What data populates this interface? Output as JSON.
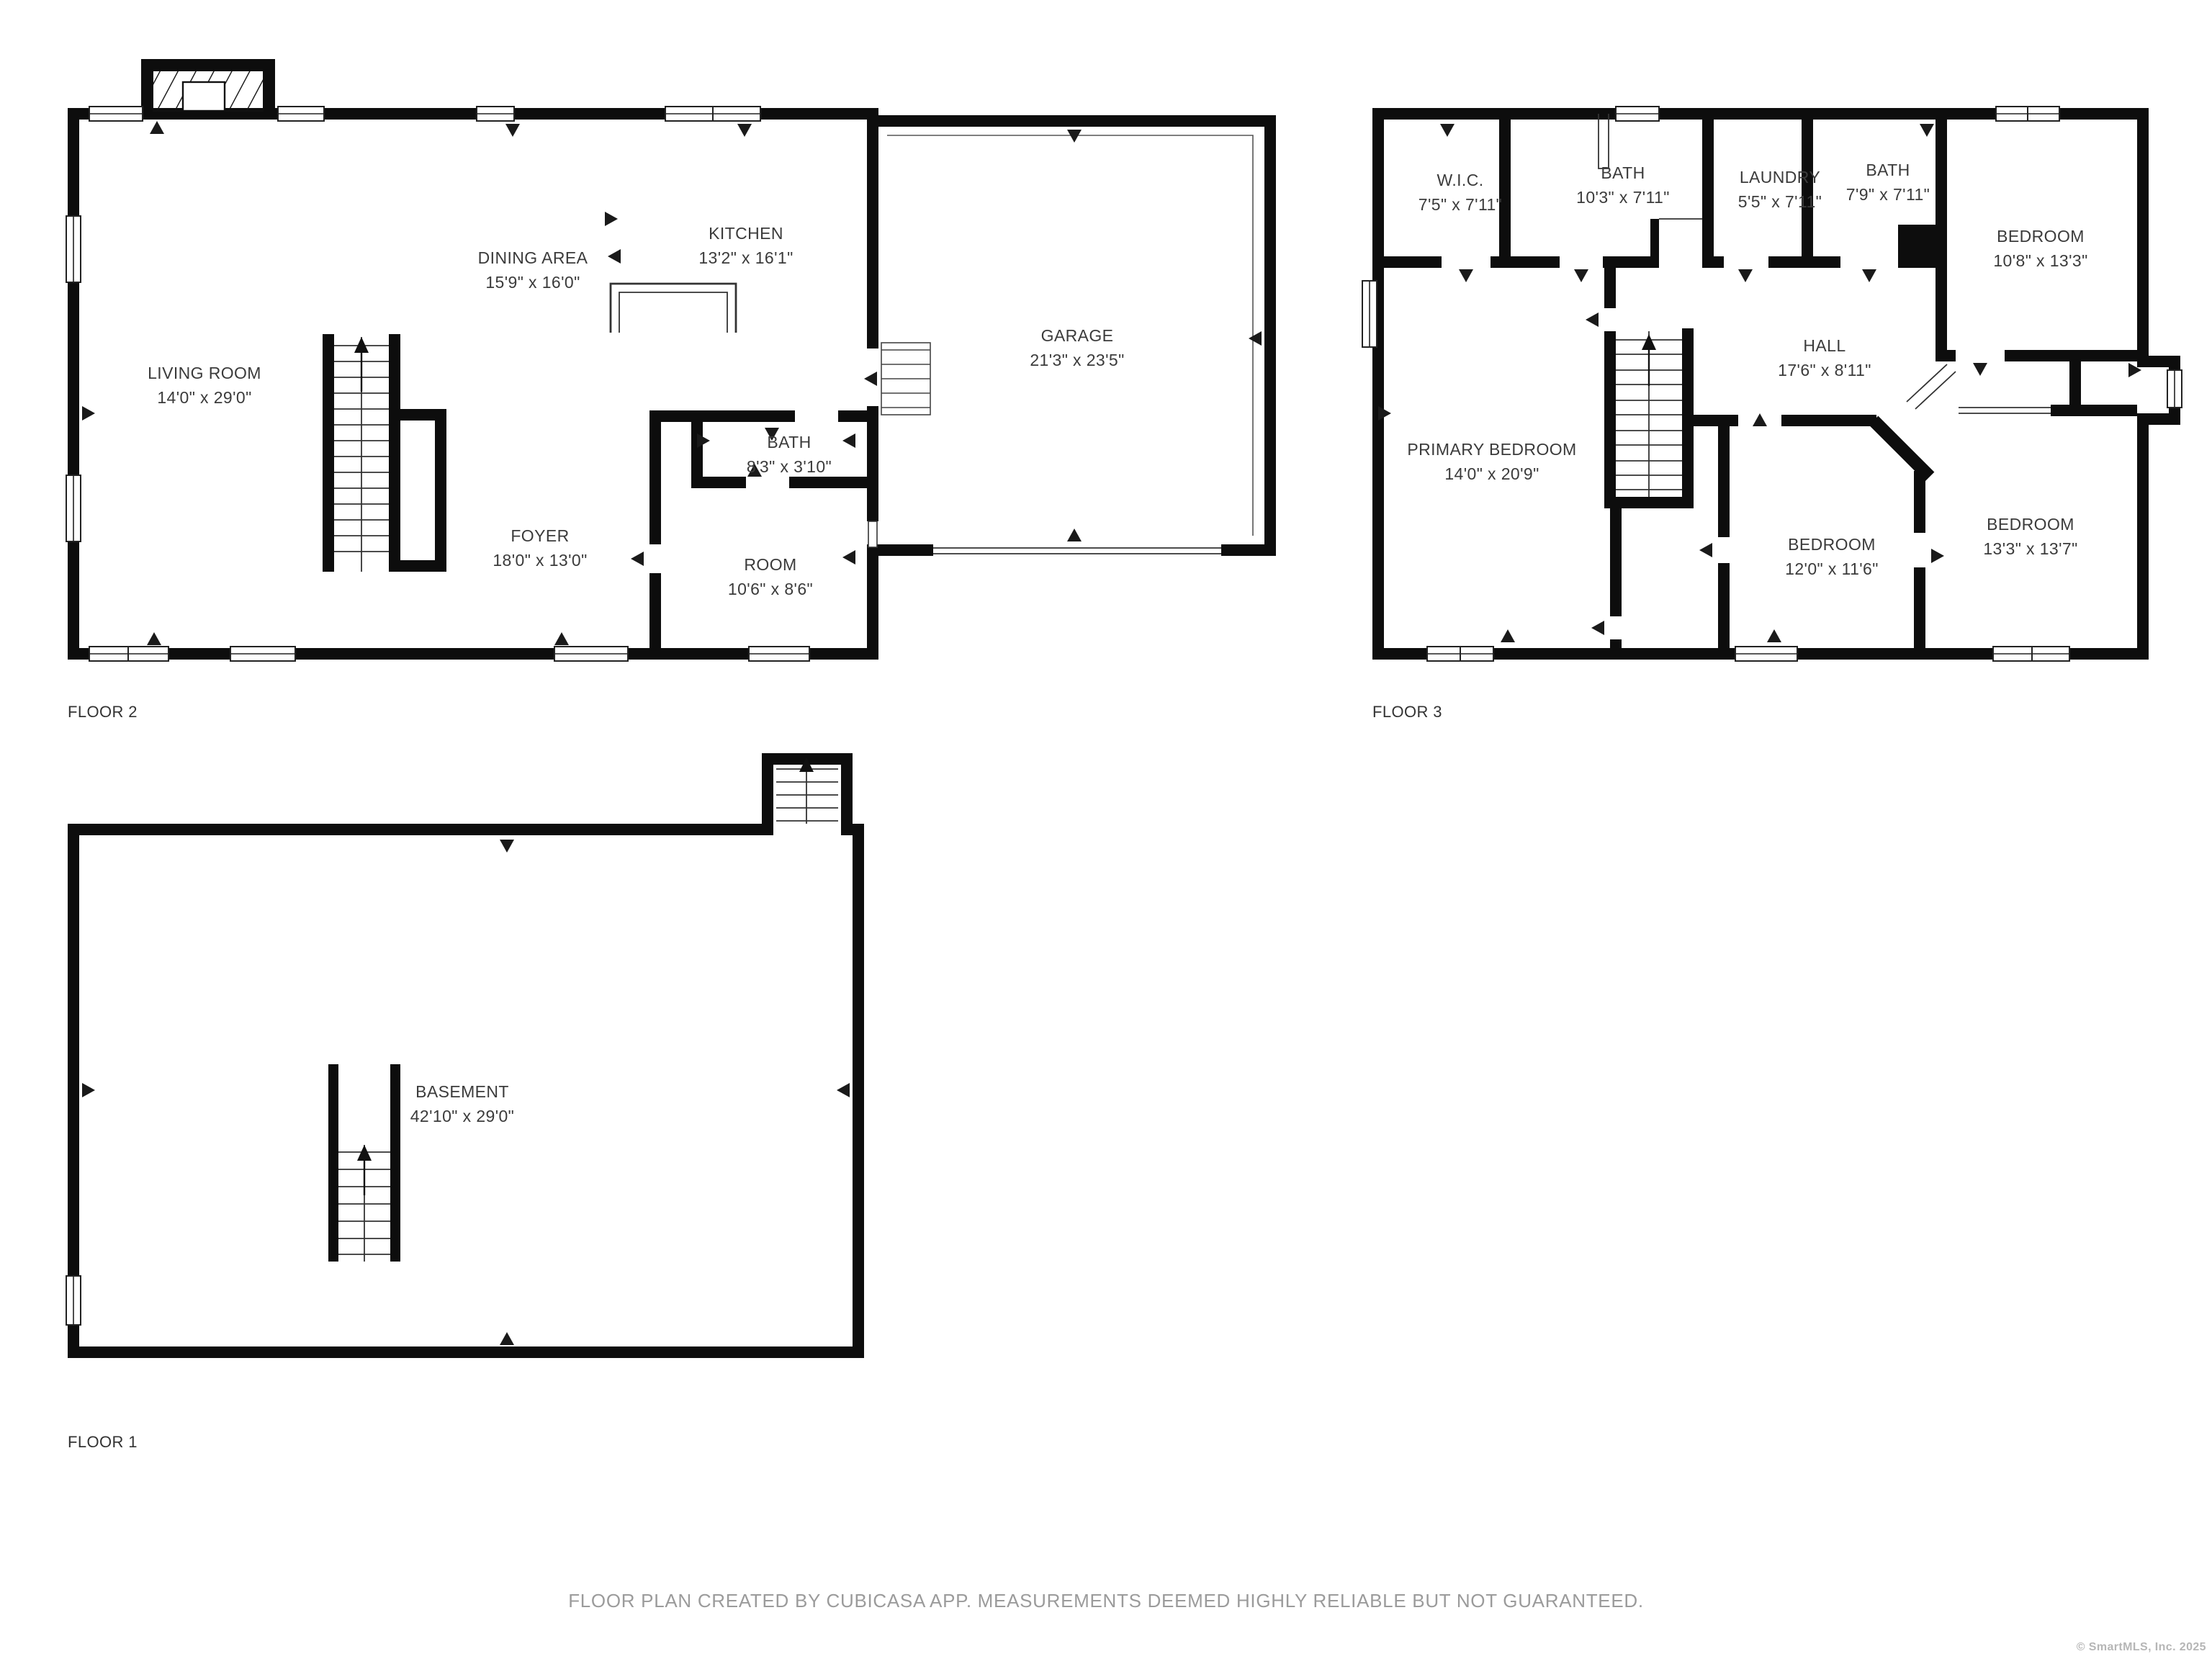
{
  "meta": {
    "footer": "FLOOR PLAN CREATED BY CUBICASA APP. MEASUREMENTS DEEMED HIGHLY RELIABLE BUT NOT GUARANTEED.",
    "copyright": "© SmartMLS, Inc.  2025",
    "wall_color": "#0d0d0d",
    "label_color": "#3b3b3b",
    "footer_color": "#9b9b9b"
  },
  "floors": [
    {
      "id": "floor2",
      "label": "FLOOR 2",
      "rooms": [
        {
          "name": "LIVING ROOM",
          "dims": "14'0\" x 29'0\""
        },
        {
          "name": "DINING AREA",
          "dims": "15'9\" x 16'0\""
        },
        {
          "name": "KITCHEN",
          "dims": "13'2\" x 16'1\""
        },
        {
          "name": "GARAGE",
          "dims": "21'3\" x 23'5\""
        },
        {
          "name": "BATH",
          "dims": "8'3\" x 3'10\""
        },
        {
          "name": "FOYER",
          "dims": "18'0\" x 13'0\""
        },
        {
          "name": "ROOM",
          "dims": "10'6\" x 8'6\""
        }
      ]
    },
    {
      "id": "floor3",
      "label": "FLOOR 3",
      "rooms": [
        {
          "name": "W.I.C.",
          "dims": "7'5\" x 7'11\""
        },
        {
          "name": "BATH",
          "dims": "10'3\" x 7'11\""
        },
        {
          "name": "LAUNDRY",
          "dims": "5'5\" x 7'11\""
        },
        {
          "name": "BATH",
          "dims": "7'9\" x 7'11\""
        },
        {
          "name": "BEDROOM",
          "dims": "10'8\" x 13'3\""
        },
        {
          "name": "HALL",
          "dims": "17'6\" x 8'11\""
        },
        {
          "name": "PRIMARY BEDROOM",
          "dims": "14'0\" x 20'9\""
        },
        {
          "name": "BEDROOM",
          "dims": "12'0\" x 11'6\""
        },
        {
          "name": "BEDROOM",
          "dims": "13'3\" x 13'7\""
        }
      ]
    },
    {
      "id": "floor1",
      "label": "FLOOR 1",
      "rooms": [
        {
          "name": "BASEMENT",
          "dims": "42'10\" x 29'0\""
        }
      ]
    }
  ]
}
